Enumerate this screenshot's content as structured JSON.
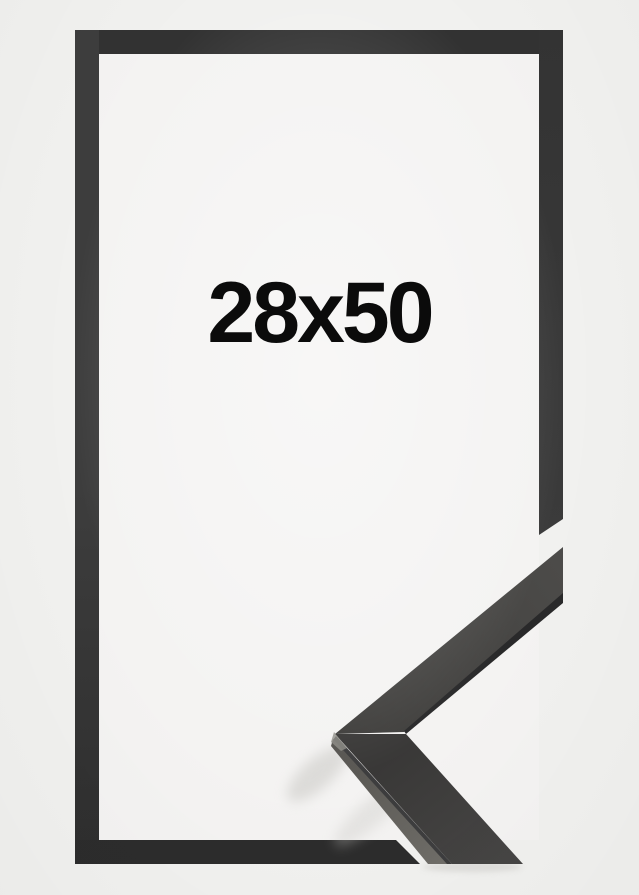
{
  "product_image": {
    "size_label": "28x50"
  },
  "colors": {
    "background": "#f1f1ef",
    "inner_background": "#f4f3f2",
    "outline_top": "#323232",
    "outline_bottom": "#2c2c2c",
    "outline_side_light": "#3d3d3d",
    "outline_side_dark": "#2e2e2e",
    "outline_right_top": "#333333",
    "outline_right_bottom": "#3b3b3b",
    "label_text": "#0b0b0b",
    "moulding_face_light": "#4c4b49",
    "moulding_face_dark": "#3d3c3a",
    "moulding_face_bottom_start": "#393837",
    "moulding_face_bottom_end": "#464544",
    "moulding_edge_dark": "#29292a",
    "moulding_side_dark": "#55534f",
    "moulding_side_light": "#6f6d68",
    "moulding_highlight": "#8d8c86",
    "shadow": "#c9c8c4"
  }
}
